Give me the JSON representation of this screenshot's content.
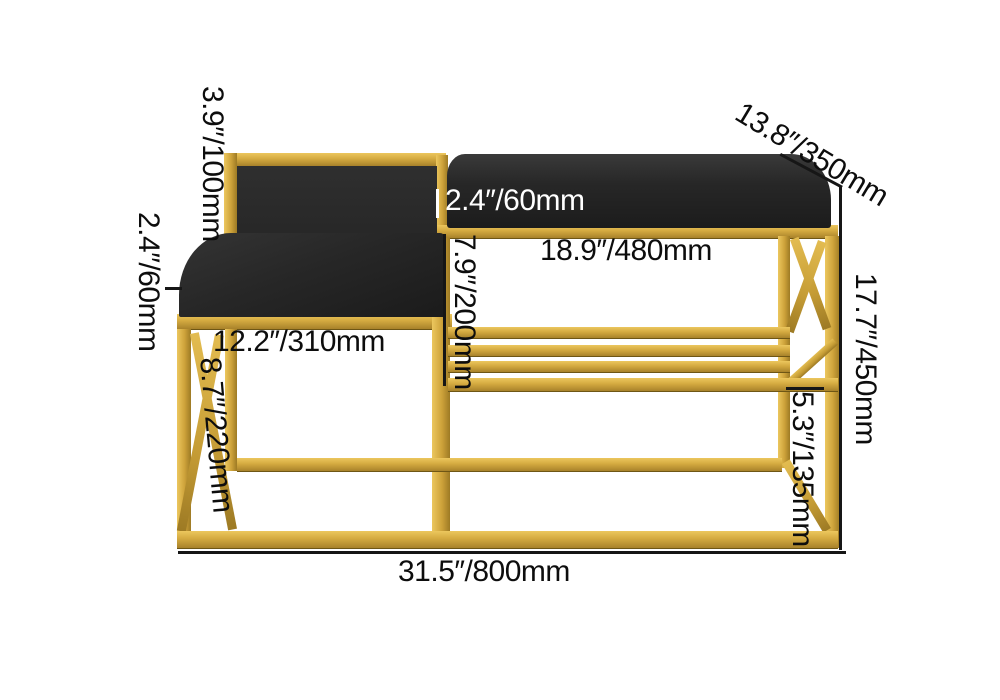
{
  "diagram": {
    "product_name": "Gold Shoe Rack Bench with Black Cushions",
    "background": "#ffffff",
    "colors": {
      "frame_gold": "#CDA23A",
      "cushion_black": "#262626",
      "dimension_text": "#0D0D0D",
      "dimension_text_on_cushion": "#FFFFFF"
    },
    "dimensions": {
      "backrest_height": "3.9″/100mm",
      "seat_cushion_thickness": "2.4″/60mm",
      "seat_width": "12.2″/310mm",
      "leg_height": "8.7″/220mm",
      "bench_cushion_thickness": "2.4″/60mm",
      "shelf_width": "18.9″/480mm",
      "shelf_clearance_height": "7.9″/200mm",
      "bench_depth": "13.8″/350mm",
      "frame_height": "17.7″/450mm",
      "bottom_clearance_height": "5.3″/135mm",
      "overall_width": "31.5″/800mm"
    }
  }
}
